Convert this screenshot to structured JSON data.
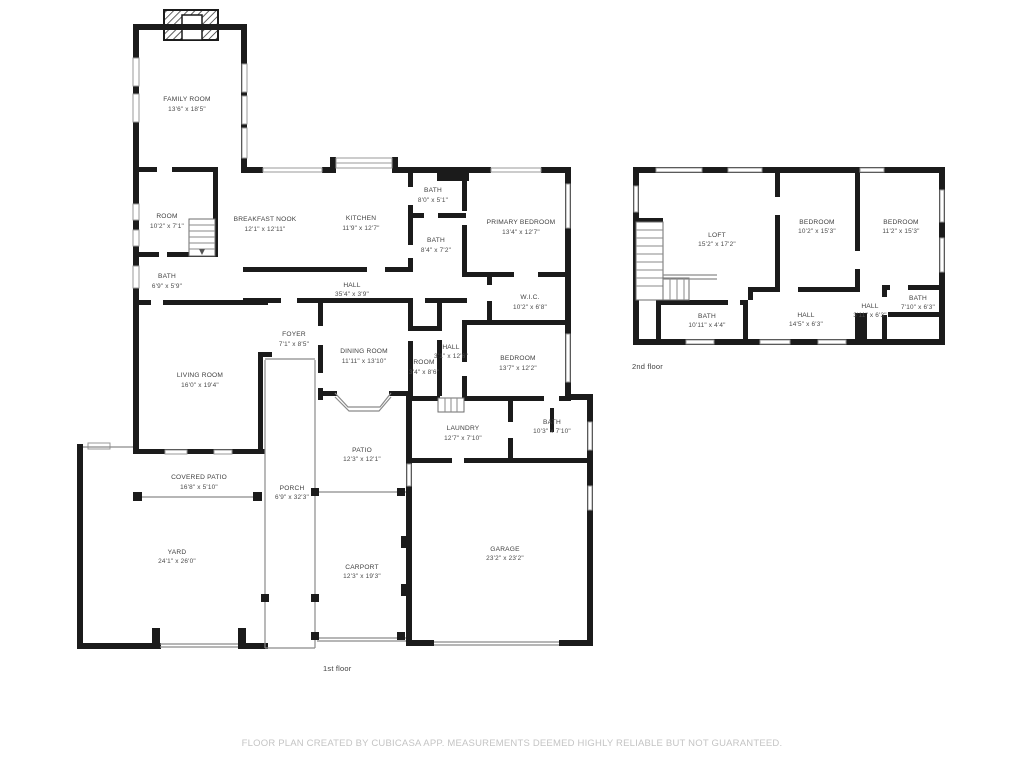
{
  "colors": {
    "walls": "#1b1b1b",
    "label_text": "#3f3f3f",
    "footer_text": "#c4c4c4"
  },
  "footer": {
    "text": "FLOOR PLAN CREATED BY CUBICASA APP. MEASUREMENTS DEEMED HIGHLY RELIABLE BUT NOT GUARANTEED."
  },
  "floors": {
    "first": {
      "caption": "1st floor",
      "rooms": {
        "family_room": {
          "name": "FAMILY ROOM",
          "dims": "13'6\" x 18'5\""
        },
        "room_upper": {
          "name": "ROOM",
          "dims": "10'2\" x 7'1\""
        },
        "breakfast_nook": {
          "name": "BREAKFAST NOOK",
          "dims": "12'1\" x 12'11\""
        },
        "kitchen": {
          "name": "KITCHEN",
          "dims": "11'9\" x 12'7\""
        },
        "bath_top": {
          "name": "BATH",
          "dims": "8'0\" x 5'1\""
        },
        "bath_mid": {
          "name": "BATH",
          "dims": "8'4\" x 7'2\""
        },
        "primary_bedroom": {
          "name": "PRIMARY BEDROOM",
          "dims": "13'4\" x 12'7\""
        },
        "bath_left": {
          "name": "BATH",
          "dims": "6'9\" x 5'9\""
        },
        "hall": {
          "name": "HALL",
          "dims": "35'4\" x 3'9\""
        },
        "wic": {
          "name": "W.I.C.",
          "dims": "10'2\" x 6'8\""
        },
        "foyer": {
          "name": "FOYER",
          "dims": "7'1\" x 8'5\""
        },
        "dining_room": {
          "name": "DINING ROOM",
          "dims": "11'11\" x 13'10\""
        },
        "room_small": {
          "name": "ROOM",
          "dims": "3'4\" x 8'6\""
        },
        "hall_small": {
          "name": "HALL",
          "dims": "3'1\" x 12'6\""
        },
        "bedroom": {
          "name": "BEDROOM",
          "dims": "13'7\" x 12'2\""
        },
        "living_room": {
          "name": "LIVING ROOM",
          "dims": "16'0\" x 19'4\""
        },
        "laundry": {
          "name": "LAUNDRY",
          "dims": "12'7\" x 7'10\""
        },
        "bath_right": {
          "name": "BATH",
          "dims": "10'3\" x 7'10\""
        },
        "covered_patio": {
          "name": "COVERED PATIO",
          "dims": "16'8\" x 5'10\""
        },
        "porch": {
          "name": "PORCH",
          "dims": "6'9\" x 32'3\""
        },
        "patio": {
          "name": "PATIO",
          "dims": "12'3\" x 12'1\""
        },
        "yard": {
          "name": "YARD",
          "dims": "24'1\" x 26'0\""
        },
        "carport": {
          "name": "CARPORT",
          "dims": "12'3\" x 19'3\""
        },
        "garage": {
          "name": "GARAGE",
          "dims": "23'2\" x 23'2\""
        }
      }
    },
    "second": {
      "caption": "2nd floor",
      "rooms": {
        "loft": {
          "name": "LOFT",
          "dims": "15'2\" x 17'2\""
        },
        "bedroom_left": {
          "name": "BEDROOM",
          "dims": "10'2\" x 15'3\""
        },
        "bedroom_right": {
          "name": "BEDROOM",
          "dims": "11'2\" x 15'3\""
        },
        "bath_left": {
          "name": "BATH",
          "dims": "10'11\" x 4'4\""
        },
        "hall": {
          "name": "HALL",
          "dims": "14'5\" x 6'3\""
        },
        "hall_small": {
          "name": "HALL",
          "dims": "3'11\" x 6'3\""
        },
        "bath_right": {
          "name": "BATH",
          "dims": "7'10\" x 6'3\""
        }
      }
    }
  }
}
